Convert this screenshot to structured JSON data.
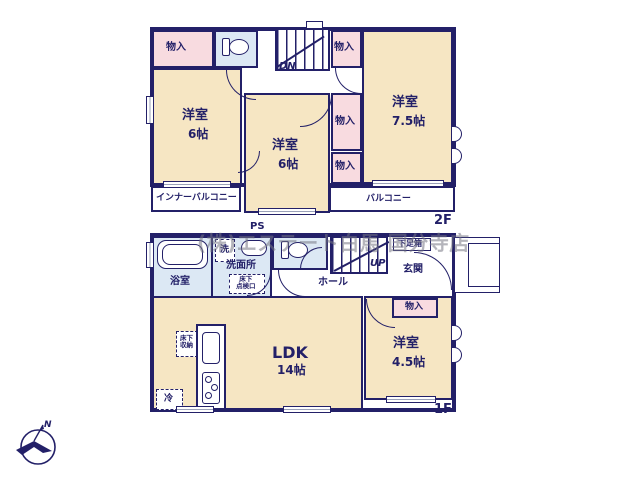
{
  "watermark": "(株)エステート白馬 国分寺店",
  "compass": {
    "north": "N"
  },
  "colors": {
    "wall": "#232068",
    "room_fill": "#f6e6c3",
    "closet_fill": "#f8dbe0",
    "wet_area_fill": "#dce8f4"
  },
  "floor2": {
    "floor_label": "2F",
    "closet_top_left": "物入",
    "closet_top_right": "物入",
    "closet_mid_upper": "物入",
    "closet_mid_lower": "物入",
    "stairs_down": "DN",
    "room_west": {
      "name": "洋室",
      "size": "6帖"
    },
    "room_center": {
      "name": "洋室",
      "size": "6帖"
    },
    "room_east": {
      "name": "洋室",
      "size": "7.5帖"
    },
    "inner_balcony": "インナーバルコニー",
    "balcony": "バルコニー"
  },
  "floor1": {
    "floor_label": "1F",
    "bathroom": "浴室",
    "washer": "洗",
    "washroom": "洗面所",
    "inspection_hatch": [
      "床下",
      "点検口"
    ],
    "pipe_space": "PS",
    "hall": "ホール",
    "stairs_up": "UP",
    "entrance": "玄関",
    "shoe_box": "下足箱",
    "closet": "物入",
    "ldk": {
      "name": "LDK",
      "size": "14帖"
    },
    "room": {
      "name": "洋室",
      "size": "4.5帖"
    },
    "underfloor_storage": [
      "床下",
      "収納"
    ],
    "fridge": "冷"
  }
}
